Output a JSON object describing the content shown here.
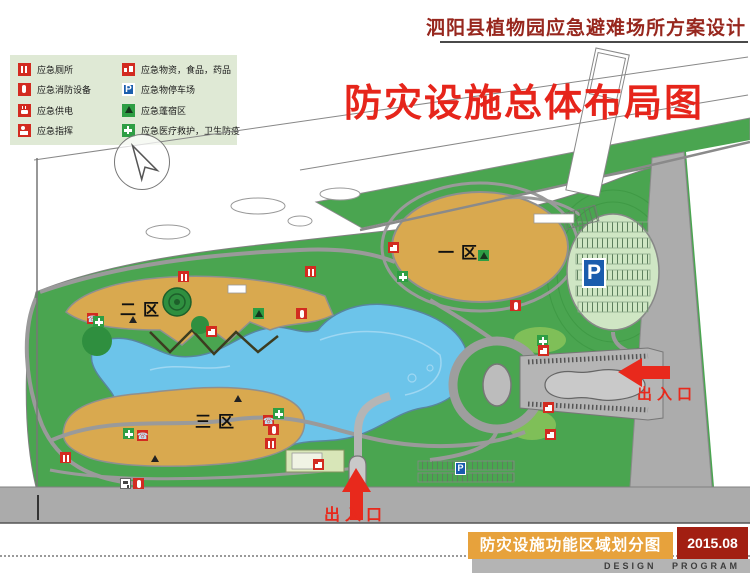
{
  "header": {
    "title": "泗阳县植物园应急避难场所方案设计"
  },
  "map_overlay_title": "防灾设施总体布局图",
  "legend": {
    "left": [
      {
        "icon": "toilet-icon",
        "label": "应急厕所"
      },
      {
        "icon": "fire-extinguisher-icon",
        "label": "应急消防设备"
      },
      {
        "icon": "power-icon",
        "label": "应急供电"
      },
      {
        "icon": "command-icon",
        "label": "应急指挥"
      },
      {
        "icon": "phone-icon",
        "label": "应急通信"
      }
    ],
    "right": [
      {
        "icon": "supplies-icon",
        "label": "应急物资，食品，药品"
      },
      {
        "icon": "parking-icon",
        "label": "应急物停车场"
      },
      {
        "icon": "tent-icon",
        "label": "应急蓬宿区"
      },
      {
        "icon": "medical-cross-icon",
        "label": "应急医疗救护，卫生防疫"
      },
      {
        "icon": "water-icon",
        "label": "应急供水"
      }
    ]
  },
  "zones": [
    {
      "label": "一区"
    },
    {
      "label": "二区"
    },
    {
      "label": "三区"
    }
  ],
  "entrances": [
    {
      "label": "出入口",
      "direction": "east"
    },
    {
      "label": "出入口",
      "direction": "south"
    }
  ],
  "parking": {
    "main_label": "P",
    "small_label": "P"
  },
  "footer": {
    "subtitle": "防灾设施功能区域划分图",
    "date": "2015.08",
    "program_label": "DESIGN PROGRAM"
  },
  "map_icons": [
    {
      "x": 178,
      "y": 271,
      "type": "toilet"
    },
    {
      "x": 305,
      "y": 266,
      "type": "toilet"
    },
    {
      "x": 60,
      "y": 452,
      "type": "toilet"
    },
    {
      "x": 265,
      "y": 438,
      "type": "toilet"
    },
    {
      "x": 87,
      "y": 313,
      "type": "phone"
    },
    {
      "x": 137,
      "y": 430,
      "type": "phone"
    },
    {
      "x": 263,
      "y": 415,
      "type": "phone"
    },
    {
      "x": 93,
      "y": 316,
      "type": "medical"
    },
    {
      "x": 397,
      "y": 271,
      "type": "medical"
    },
    {
      "x": 123,
      "y": 428,
      "type": "medical"
    },
    {
      "x": 273,
      "y": 408,
      "type": "medical"
    },
    {
      "x": 537,
      "y": 335,
      "type": "medical"
    },
    {
      "x": 478,
      "y": 250,
      "type": "tent"
    },
    {
      "x": 253,
      "y": 308,
      "type": "tent"
    },
    {
      "x": 128,
      "y": 314,
      "type": "tentd"
    },
    {
      "x": 233,
      "y": 393,
      "type": "tentd"
    },
    {
      "x": 150,
      "y": 453,
      "type": "tentd"
    },
    {
      "x": 296,
      "y": 308,
      "type": "fire"
    },
    {
      "x": 510,
      "y": 300,
      "type": "fire"
    },
    {
      "x": 268,
      "y": 424,
      "type": "fire"
    },
    {
      "x": 133,
      "y": 478,
      "type": "fire"
    },
    {
      "x": 206,
      "y": 326,
      "type": "supplies"
    },
    {
      "x": 388,
      "y": 242,
      "type": "supplies"
    },
    {
      "x": 538,
      "y": 345,
      "type": "supplies"
    },
    {
      "x": 543,
      "y": 402,
      "type": "supplies"
    },
    {
      "x": 545,
      "y": 429,
      "type": "supplies"
    },
    {
      "x": 313,
      "y": 459,
      "type": "supplies"
    },
    {
      "x": 120,
      "y": 478,
      "type": "water"
    }
  ],
  "colors": {
    "header_red": "#97271E",
    "calligraphy_red": "#E6251B",
    "arrow_red": "#E8291C",
    "park_green": "#4AA550",
    "zone_orange": "#D9A94F",
    "lake_blue": "#6CC4EA",
    "road_gray": "#ABABAB",
    "legend_bg": "#DFE9D5",
    "icon_red": "#D22B20",
    "icon_green": "#2E9E44",
    "parking_blue": "#1B5FAD",
    "footer_orange": "#E7A23C",
    "footer_red": "#A21F12"
  }
}
